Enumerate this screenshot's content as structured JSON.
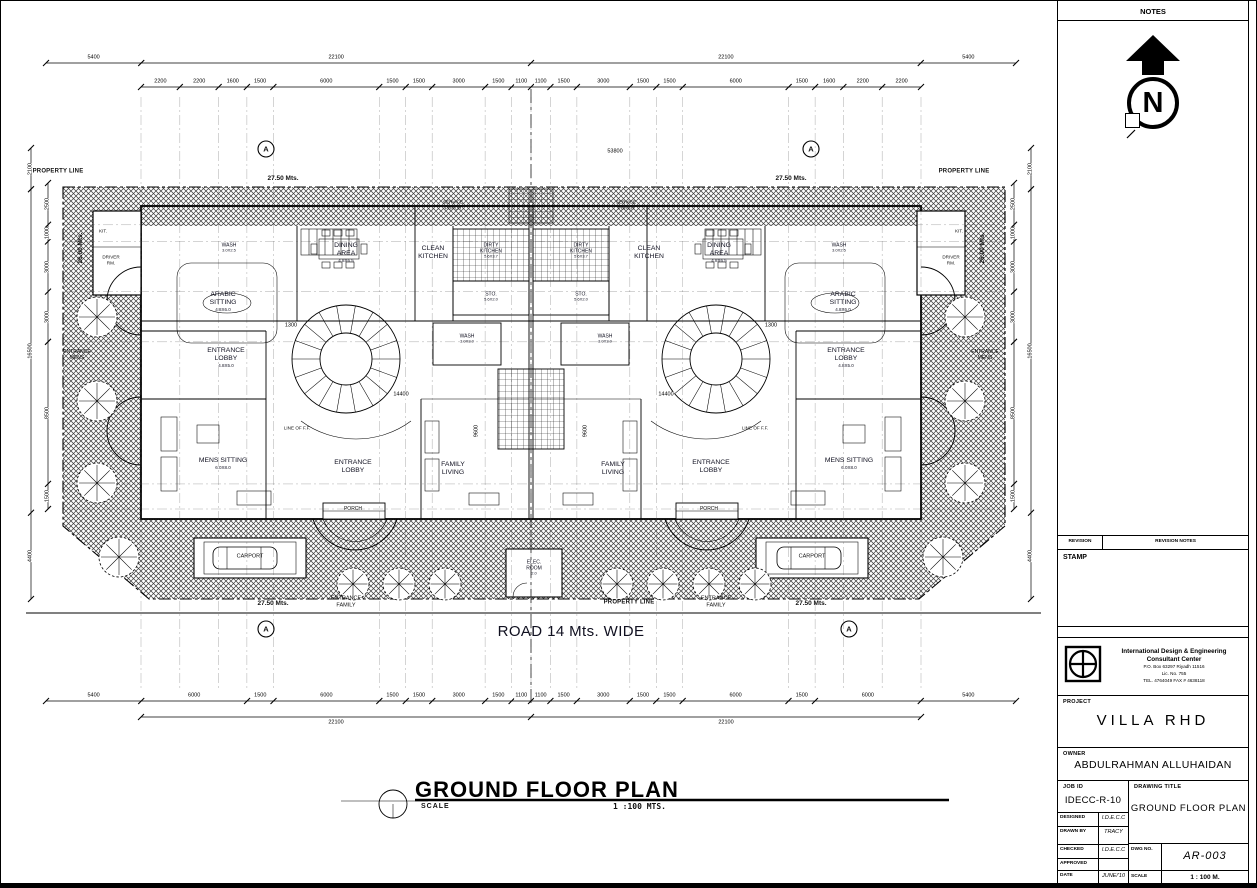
{
  "sheet": {
    "notes_label": "NOTES",
    "north_symbol": "N",
    "revision_label": "REVISION",
    "revision_notes_label": "REVISION NOTES",
    "stamp_label": "STAMP",
    "company": {
      "name_line1": "International Design & Engineering",
      "name_line2": "Consultant Center",
      "address": "P.O. Box 63297  Riyadh 11516",
      "license": "Lic. No. 755",
      "tel": "TEL. 4764049  FAX # 4638118"
    },
    "project": {
      "label": "PROJECT",
      "value": "VILLA RHD"
    },
    "owner": {
      "label": "OWNER",
      "value": "ABDULRAHMAN ALLUHAIDAN"
    },
    "job": {
      "label": "JOB ID",
      "value": "IDECC-R-10"
    },
    "drawing_title": {
      "label": "DRAWING TITLE",
      "value": "GROUND FLOOR PLAN"
    },
    "table": {
      "designed": {
        "label": "DESIGNED",
        "value": "I.D.E.C.C"
      },
      "drawn_by": {
        "label": "DRAWN BY",
        "value": "TRACY"
      },
      "checked": {
        "label": "CHECKED",
        "value": "I.D.E.C.C"
      },
      "approved": {
        "label": "APPROVED",
        "value": ""
      },
      "date": {
        "label": "DATE",
        "value": "JUNE/'10"
      },
      "dwg_no": {
        "label": "DWG NO.",
        "value": "AR-003"
      },
      "scale": {
        "label": "SCALE",
        "value": "1 : 100 M."
      }
    }
  },
  "plan": {
    "title": "GROUND FLOOR PLAN",
    "scale_label": "SCALE",
    "scale_value": "1 :100 MTS.",
    "road_label": "ROAD 14 Mts. WIDE",
    "property_line_label": "PROPERTY LINE",
    "half_width_label": "27.50 Mts.",
    "depth_label": "26.00 Mts.",
    "overall_width_dim": "53800",
    "section_marker": "A",
    "labels": {
      "entrance_mens": "ENTRANCE MENS",
      "entrance_family": "ENTRANCE FAMILY",
      "service_porch": "SERVICE PORCH",
      "porch": "PORCH",
      "carport": "CARPORT",
      "line_of_ff": "LINE OF F.F.",
      "kit": "KIT.",
      "driver_rm": "DRIVER RM.",
      "dim_14400": "14400",
      "dim_1300": "1300",
      "dim_9600": "9600"
    },
    "rooms": {
      "entrance_lobby_corner": {
        "name": "ENTRANCE LOBBY",
        "size": "4.8X5.0"
      },
      "mens_sitting": {
        "name": "MENS SITTING",
        "size": "6.0X8.0"
      },
      "entrance_lobby": {
        "name": "ENTRANCE LOBBY",
        "size": ""
      },
      "family_living": {
        "name": "FAMILY LIVING",
        "size": ""
      },
      "arabic_sitting": {
        "name": "ARABIC SITTING",
        "size": "4.8X6.0"
      },
      "dining_area": {
        "name": "DINING AREA",
        "size": "4.8X6.5"
      },
      "clean_kitchen": {
        "name": "CLEAN KITCHEN",
        "size": ""
      },
      "dirty_kitchen": {
        "name": "DIRTY KITCHEN",
        "size": "5.6X3.7"
      },
      "storage": {
        "name": "STO.",
        "size": "5.6X2.0"
      },
      "wash": {
        "name": "WASH",
        "size": "3.0X3.0"
      },
      "wash_small": {
        "name": "WASH",
        "size": "3.0X2.5"
      },
      "elec_room": {
        "name": "ELEC. ROOM",
        "size": "2.0"
      }
    },
    "dims": {
      "top_totals": [
        "5400",
        "22100",
        "22100",
        "5400"
      ],
      "top_segments": [
        "2200",
        "2200",
        "1600",
        "1500",
        "6000",
        "1500",
        "1500",
        "3000",
        "1500",
        "1100",
        "1100",
        "1500",
        "3000",
        "1500",
        "1500",
        "6000",
        "1500",
        "1600",
        "2200",
        "2200"
      ],
      "bottom_segments": [
        "5400",
        "6000",
        "1500",
        "6000",
        "1500",
        "1500",
        "3000",
        "1500",
        "1100",
        "1100",
        "1500",
        "3000",
        "1500",
        "1500",
        "6000",
        "1500",
        "6000",
        "5400"
      ],
      "bottom_totals": [
        "22100",
        "22100"
      ],
      "left_outer": [
        "2100",
        "16500",
        "4400"
      ],
      "left_inner": [
        "2500",
        "1000",
        "3000",
        "3000",
        "8500",
        "1500"
      ]
    }
  }
}
